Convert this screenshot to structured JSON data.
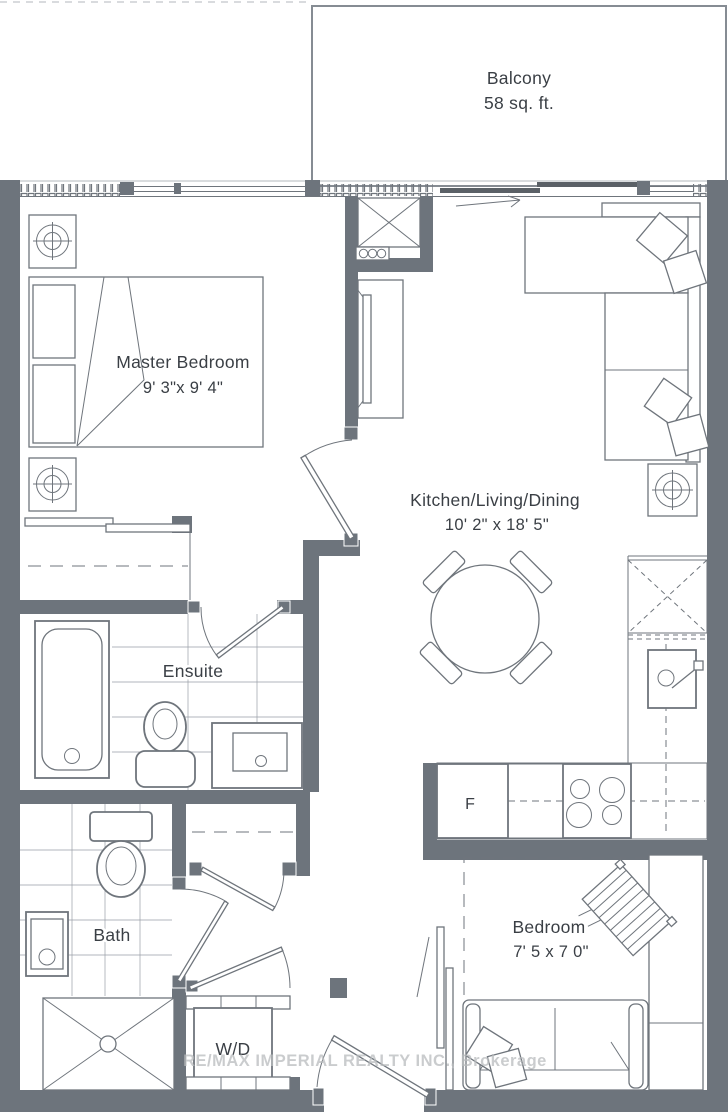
{
  "rooms": {
    "balcony": {
      "label": "Balcony",
      "area": "58 sq. ft."
    },
    "master_bedroom": {
      "label": "Master Bedroom",
      "dims": "9' 3\"x 9' 4\""
    },
    "kitchen_living_dining": {
      "label": "Kitchen/Living/Dining",
      "dims": "10' 2\" x 18' 5\""
    },
    "ensuite": {
      "label": "Ensuite"
    },
    "bath": {
      "label": "Bath"
    },
    "bedroom": {
      "label": "Bedroom",
      "dims": "7' 5 x 7 0\""
    }
  },
  "appliances": {
    "fridge": "F",
    "washer_dryer": "W/D"
  },
  "watermark": "RE/MAX IMPERIAL REALTY INC., Brokerage",
  "colors": {
    "wall": "#6d747c",
    "line": "#6f757c",
    "text": "#3a3f45",
    "wm": "#b9bcbe"
  }
}
